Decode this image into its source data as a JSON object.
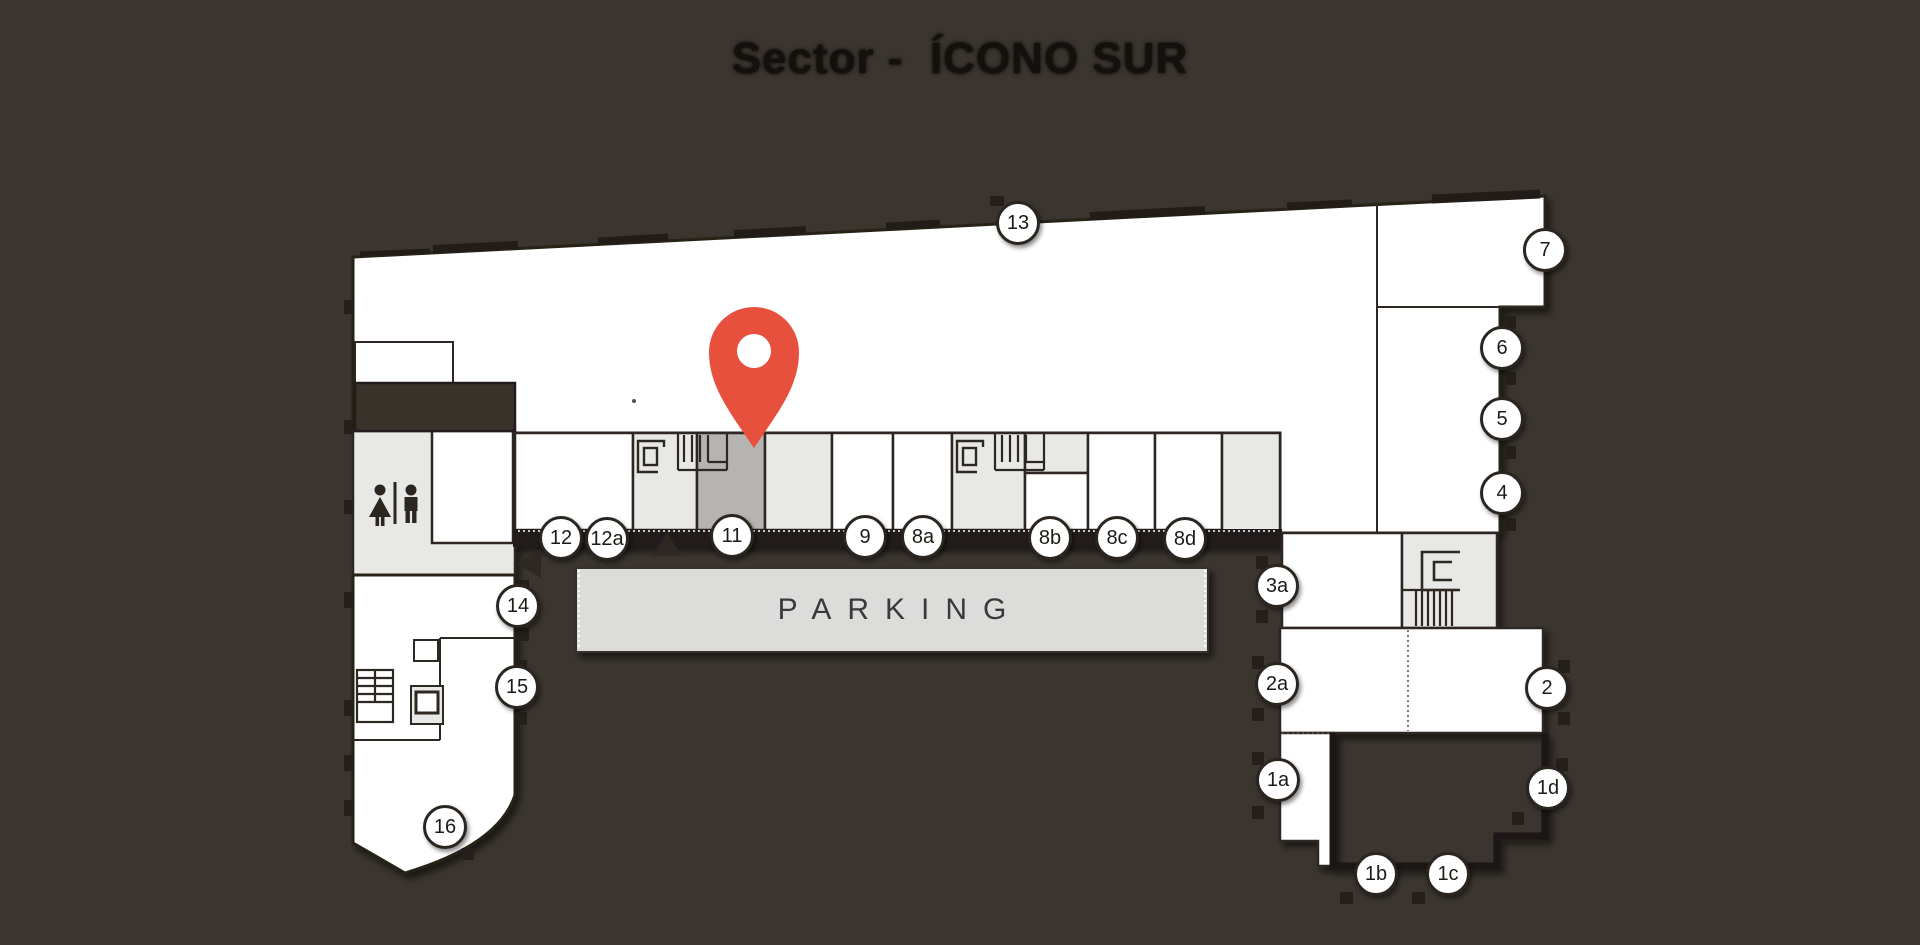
{
  "title": "Sector -  ÍCONO SUR",
  "map": {
    "parking_label": "PARKING",
    "highlighted_unit": "11",
    "colors": {
      "background": "#3b352f",
      "plan_fill": "#ffffff",
      "unit_light": "#e8e8e6",
      "unit_highlight": "#b5b4b2",
      "parking_fill": "#dcdcda",
      "wall": "#2e2823",
      "wall_dark": "#241f1a",
      "pin": "#e8503e",
      "marker_border": "#2b2520"
    },
    "icons": [
      {
        "name": "location-pin-icon"
      },
      {
        "name": "restroom-icon"
      },
      {
        "name": "stairs-icon"
      },
      {
        "name": "elevator-icon"
      }
    ],
    "markers": [
      {
        "label": "13",
        "x": 1018,
        "y": 223
      },
      {
        "label": "7",
        "x": 1545,
        "y": 250
      },
      {
        "label": "6",
        "x": 1502,
        "y": 348
      },
      {
        "label": "5",
        "x": 1502,
        "y": 419
      },
      {
        "label": "4",
        "x": 1502,
        "y": 493
      },
      {
        "label": "12",
        "x": 561,
        "y": 538
      },
      {
        "label": "12a",
        "x": 607,
        "y": 539
      },
      {
        "label": "11",
        "x": 732,
        "y": 536
      },
      {
        "label": "9",
        "x": 865,
        "y": 537
      },
      {
        "label": "8a",
        "x": 923,
        "y": 537
      },
      {
        "label": "8b",
        "x": 1050,
        "y": 538
      },
      {
        "label": "8c",
        "x": 1117,
        "y": 538
      },
      {
        "label": "8d",
        "x": 1185,
        "y": 539
      },
      {
        "label": "3a",
        "x": 1277,
        "y": 586
      },
      {
        "label": "2a",
        "x": 1277,
        "y": 684
      },
      {
        "label": "2",
        "x": 1547,
        "y": 688
      },
      {
        "label": "1a",
        "x": 1278,
        "y": 780
      },
      {
        "label": "1d",
        "x": 1548,
        "y": 788
      },
      {
        "label": "1b",
        "x": 1376,
        "y": 874
      },
      {
        "label": "1c",
        "x": 1448,
        "y": 874
      },
      {
        "label": "14",
        "x": 518,
        "y": 606
      },
      {
        "label": "15",
        "x": 517,
        "y": 687
      },
      {
        "label": "16",
        "x": 445,
        "y": 827
      }
    ]
  }
}
